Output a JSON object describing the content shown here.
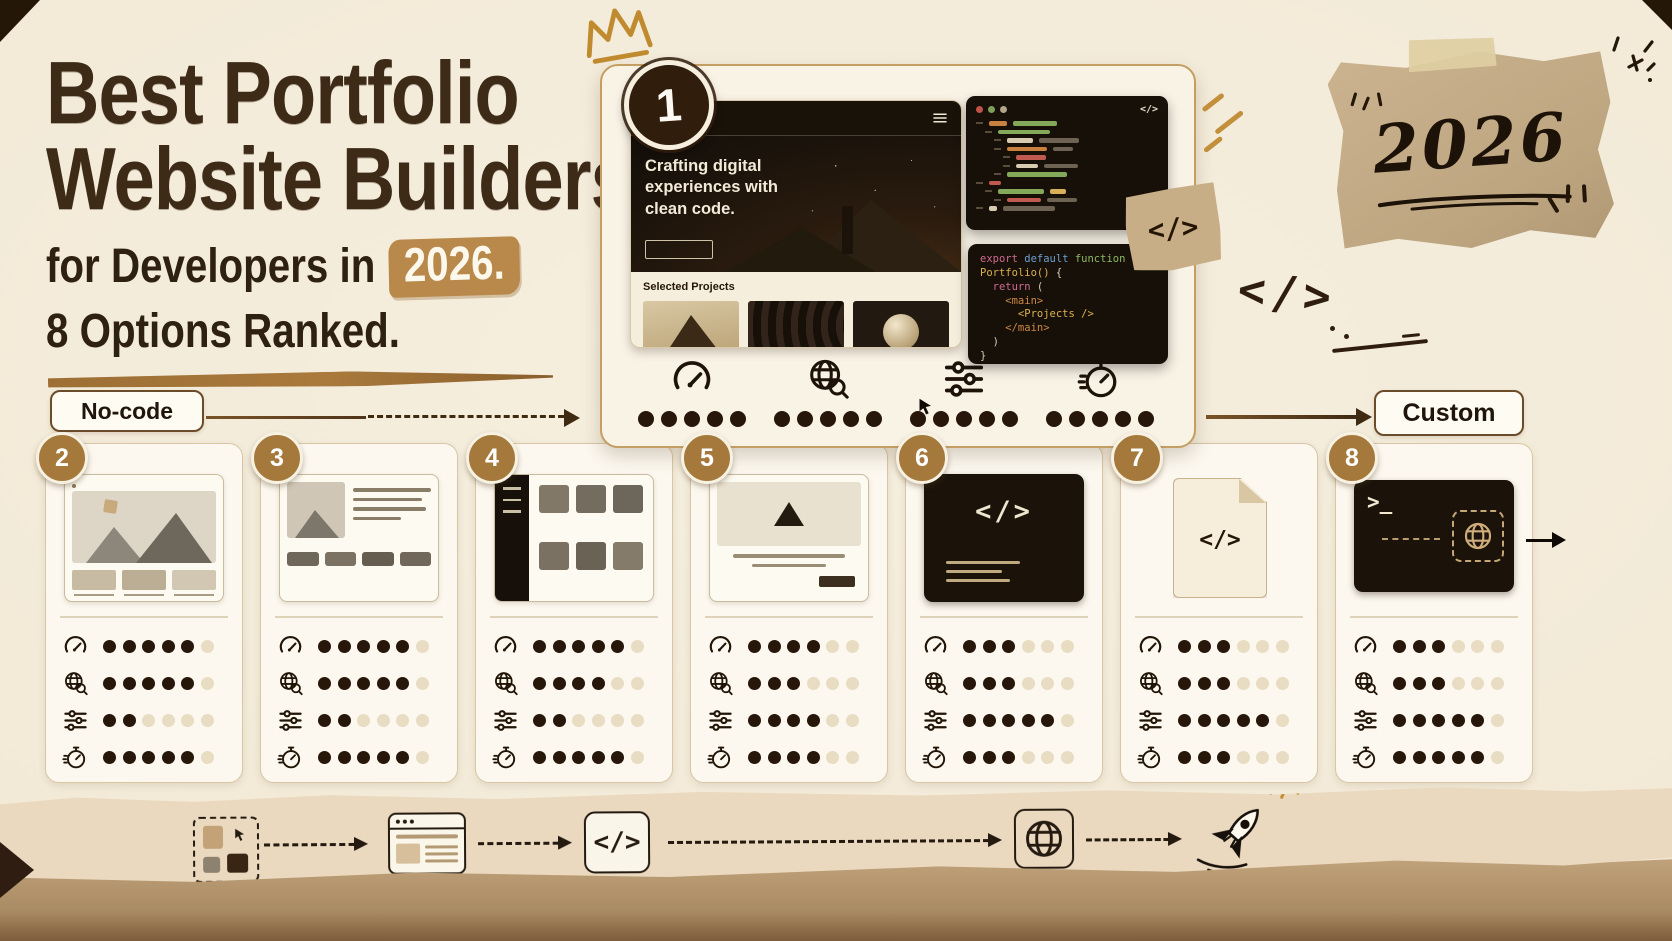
{
  "header": {
    "title_line1": "Best Portfolio",
    "title_line2": "Website Builders",
    "subtitle_prefix": "for Developers in",
    "subtitle_year": "2026.",
    "subtitle_line2": "8 Options Ranked."
  },
  "axis": {
    "left_label": "No-code",
    "right_label": "Custom"
  },
  "decor": {
    "year_note": "2026",
    "code_sticker": "</>",
    "code_doodle": "</>"
  },
  "featured": {
    "rank": "1",
    "browser": {
      "site_name": "Portfolio",
      "headline": "Crafting digital experiences with clean code.",
      "projects_label": "Selected Projects"
    },
    "editor": {
      "window_icon": "</>",
      "rows": [
        [
          0,
          [
            18,
            "o"
          ],
          [
            44,
            "g"
          ]
        ],
        [
          1,
          [
            52,
            "g"
          ]
        ],
        [
          2,
          [
            26,
            "c"
          ],
          [
            40,
            "m"
          ]
        ],
        [
          2,
          [
            40,
            "o"
          ],
          [
            20,
            "m"
          ]
        ],
        [
          3,
          [
            30,
            "r"
          ]
        ],
        [
          3,
          [
            22,
            "c"
          ],
          [
            34,
            "m"
          ]
        ],
        [
          2,
          [
            60,
            "g"
          ]
        ],
        [
          0,
          [
            12,
            "r"
          ]
        ],
        [
          1,
          [
            46,
            "g"
          ],
          [
            16,
            "y"
          ]
        ],
        [
          2,
          [
            34,
            "r"
          ],
          [
            30,
            "m"
          ]
        ],
        [
          0,
          [
            8,
            "c"
          ],
          [
            52,
            "m"
          ]
        ]
      ]
    },
    "snippet_lines": [
      [
        [
          "export",
          "pink"
        ],
        [
          " default",
          "blue"
        ],
        [
          " function",
          "green"
        ]
      ],
      [
        [
          "Portfolio()",
          "gold"
        ],
        [
          " {",
          "cream"
        ]
      ],
      [
        [
          "  return",
          "pink"
        ],
        [
          " (",
          "cream"
        ]
      ],
      [
        [
          "    <main>",
          "orange"
        ]
      ],
      [
        [
          "      <Projects />",
          "gold"
        ]
      ],
      [
        [
          "    </main>",
          "orange"
        ]
      ],
      [
        [
          "  )",
          "cream"
        ]
      ],
      [
        [
          "}",
          "cream"
        ]
      ]
    ],
    "metrics": {
      "max": 5,
      "scores": [
        5,
        5,
        5,
        5
      ]
    }
  },
  "metric_icons": [
    "speedometer",
    "globe-seo",
    "sliders",
    "stopwatch"
  ],
  "builders": [
    {
      "rank": "2",
      "thumb": "browser-hero",
      "thumb_text": "",
      "max": 6,
      "scores": [
        5,
        5,
        2,
        5
      ]
    },
    {
      "rank": "3",
      "thumb": "split-text",
      "thumb_text": "",
      "max": 6,
      "scores": [
        5,
        5,
        2,
        5
      ]
    },
    {
      "rank": "4",
      "thumb": "sidebar-grid",
      "thumb_text": "",
      "max": 6,
      "scores": [
        5,
        4,
        2,
        5
      ]
    },
    {
      "rank": "5",
      "thumb": "centered-hero",
      "thumb_text": "",
      "max": 6,
      "scores": [
        4,
        3,
        4,
        4
      ]
    },
    {
      "rank": "6",
      "thumb": "code-window",
      "thumb_text": "</>",
      "max": 6,
      "scores": [
        3,
        3,
        5,
        3
      ]
    },
    {
      "rank": "7",
      "thumb": "code-file",
      "thumb_text": "</>",
      "max": 6,
      "scores": [
        3,
        3,
        5,
        3
      ]
    },
    {
      "rank": "8",
      "thumb": "terminal-deploy",
      "thumb_text": ">_",
      "max": 6,
      "scores": [
        3,
        3,
        5,
        5
      ]
    }
  ],
  "flow": {
    "code_label": "</>",
    "items": [
      "components",
      "browser",
      "code",
      "globe",
      "rocket"
    ]
  },
  "colors": {
    "background": "#f2e9d6",
    "ink": "#3d2a17",
    "accent_tan": "#b9894c",
    "dot_filled": "#27160a",
    "dot_empty": "#e8dcc3",
    "badge_gold": "#a5793c",
    "badge_dark": "#301d0c",
    "kraft": "#c2aa85"
  }
}
